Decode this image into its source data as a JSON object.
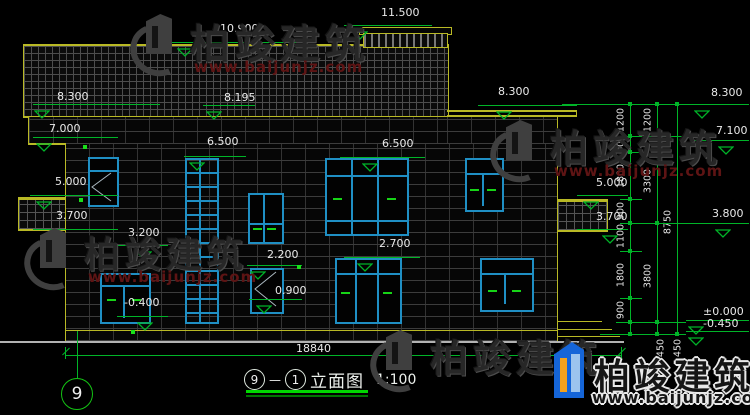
{
  "drawing": {
    "axis_bubble": "9",
    "title": {
      "left_bubble": "9",
      "dash": "—",
      "right_bubble": "1",
      "name": "立面图",
      "scale": "1:100"
    },
    "bottom_dimension": "18840"
  },
  "colors": {
    "outline_yellow": "#b9b925",
    "annotation_green": "#00b428",
    "window_cyan": "#1f8fc4",
    "text_white": "#e9e9e9",
    "watermark_red": "#5e1414",
    "logo_blue": "#1565d8",
    "logo_orange": "#f5a21b"
  },
  "elevations": [
    {
      "label": "10.900",
      "tx": 220,
      "ty": 23,
      "lx1": 164,
      "lx2": 305,
      "ly": 42,
      "trx": 177
    },
    {
      "label": "11.500",
      "tx": 381,
      "ty": 7,
      "lx1": 344,
      "lx2": 432,
      "ly": 25,
      "trx": 352
    },
    {
      "label": "8.300",
      "tx": 57,
      "ty": 91,
      "lx1": 33,
      "lx2": 160,
      "ly": 104,
      "trx": 34
    },
    {
      "label": "8.195",
      "tx": 224,
      "ty": 92,
      "lx1": 203,
      "lx2": 255,
      "ly": 105,
      "trx": 206
    },
    {
      "label": "8.300",
      "tx": 498,
      "ty": 86,
      "lx1": 478,
      "lx2": 577,
      "ly": 105,
      "trx": 496
    },
    {
      "label": "8.300",
      "tx": 711,
      "ty": 87,
      "lx1": 692,
      "lx2": 749,
      "ly": 104,
      "trx": 694
    },
    {
      "label": "7.000",
      "tx": 49,
      "ty": 123,
      "lx1": 33,
      "lx2": 118,
      "ly": 137,
      "trx": 36
    },
    {
      "label": "7.100",
      "tx": 716,
      "ty": 125,
      "lx1": 692,
      "lx2": 749,
      "ly": 140,
      "trx": 718
    },
    {
      "label": "6.500",
      "tx": 207,
      "ty": 136,
      "lx1": 184,
      "lx2": 246,
      "ly": 156,
      "trx": 189
    },
    {
      "label": "6.500",
      "tx": 382,
      "ty": 138,
      "lx1": 340,
      "lx2": 425,
      "ly": 157,
      "trx": 362
    },
    {
      "label": "5.000",
      "tx": 55,
      "ty": 176,
      "lx1": 30,
      "lx2": 118,
      "ly": 195,
      "trx": 36
    },
    {
      "label": "5.000",
      "tx": 596,
      "ty": 177,
      "lx1": 577,
      "lx2": 628,
      "ly": 195,
      "trx": 583
    },
    {
      "label": "3.700",
      "tx": 56,
      "ty": 210,
      "lx1": 33,
      "lx2": 118,
      "ly": 229,
      "trx": 40
    },
    {
      "label": "3.700",
      "tx": 596,
      "ty": 211,
      "lx1": 577,
      "lx2": 628,
      "ly": 229,
      "trx": 602
    },
    {
      "label": "3.800",
      "tx": 712,
      "ty": 208,
      "lx1": 692,
      "lx2": 749,
      "ly": 223,
      "trx": 715
    },
    {
      "label": "3.200",
      "tx": 128,
      "ty": 227,
      "lx1": 117,
      "lx2": 168,
      "ly": 245,
      "trx": 136
    },
    {
      "label": "2.700",
      "tx": 379,
      "ty": 238,
      "lx1": 344,
      "lx2": 420,
      "ly": 257,
      "trx": 357
    },
    {
      "label": "2.200",
      "tx": 267,
      "ty": 249,
      "lx1": 247,
      "lx2": 302,
      "ly": 265,
      "trx": 250
    },
    {
      "label": "0.900",
      "tx": 275,
      "ty": 285,
      "lx1": 249,
      "lx2": 302,
      "ly": 299,
      "trx": 256
    },
    {
      "label": "-0.400",
      "tx": 124,
      "ty": 297,
      "lx1": 117,
      "lx2": 168,
      "ly": 316,
      "trx": 137
    },
    {
      "label": "±0.000",
      "tx": 703,
      "ty": 306,
      "lx1": 686,
      "lx2": 749,
      "ly": 320,
      "trx": 688
    },
    {
      "label": "-0.450",
      "tx": 703,
      "ty": 318,
      "lx1": 686,
      "lx2": 749,
      "ly": 331,
      "trx": 688
    }
  ],
  "dim_chains": [
    {
      "x": 630,
      "y1": 104,
      "y2": 334,
      "ticks": [
        104,
        136,
        152,
        199,
        223,
        251,
        298,
        322,
        334
      ],
      "labels": [
        {
          "t": "1200",
          "y": 120
        },
        {
          "t": "600",
          "y": 144
        },
        {
          "t": "1800",
          "y": 176
        },
        {
          "t": "900",
          "y": 211
        },
        {
          "t": "1100",
          "y": 236
        },
        {
          "t": "1800",
          "y": 275
        },
        {
          "t": "900",
          "y": 310
        }
      ]
    },
    {
      "x": 657,
      "y1": 104,
      "y2": 334,
      "ticks": [
        104,
        136,
        223,
        322,
        334
      ],
      "labels": [
        {
          "t": "1200",
          "y": 120
        },
        {
          "t": "3300",
          "y": 181
        },
        {
          "t": "3800",
          "y": 276
        }
      ]
    },
    {
      "x": 677,
      "y1": 104,
      "y2": 334,
      "ticks": [
        104,
        334
      ],
      "labels": [
        {
          "t": "8750",
          "y": 222
        }
      ]
    }
  ],
  "chain_extra_labels": [
    {
      "t": "450",
      "x": 661,
      "y": 348
    },
    {
      "t": "450",
      "x": 678,
      "y": 348
    }
  ],
  "right_connectors": [
    {
      "y": 104,
      "x1": 562,
      "x2": 692
    },
    {
      "y": 136,
      "x1": 620,
      "x2": 692
    },
    {
      "y": 152,
      "x1": 620,
      "x2": 642
    },
    {
      "y": 199,
      "x1": 620,
      "x2": 642
    },
    {
      "y": 223,
      "x1": 620,
      "x2": 712
    },
    {
      "y": 251,
      "x1": 620,
      "x2": 642
    },
    {
      "y": 298,
      "x1": 620,
      "x2": 642
    },
    {
      "y": 322,
      "x1": 616,
      "x2": 686
    },
    {
      "y": 334,
      "x1": 600,
      "x2": 686
    }
  ],
  "green_dots": [
    {
      "x": 83,
      "y": 145
    },
    {
      "x": 79,
      "y": 198
    },
    {
      "x": 131,
      "y": 330
    },
    {
      "x": 297,
      "y": 265
    }
  ],
  "watermark": {
    "brand": "柏竣建筑",
    "url": "www.baijunjz.com",
    "instances": [
      {
        "style": "dark",
        "x": 128,
        "y": 10,
        "size": 40,
        "logo": "gray"
      },
      {
        "style": "dark",
        "x": 22,
        "y": 224,
        "size": 36,
        "logo": "gray"
      },
      {
        "style": "dark",
        "x": 488,
        "y": 116,
        "size": 38,
        "logo": "gray"
      },
      {
        "style": "dark",
        "x": 368,
        "y": 326,
        "size": 38,
        "logo": "gray",
        "nourl": true
      },
      {
        "style": "bright",
        "x": 552,
        "y": 340,
        "size": 36,
        "logo": "blue"
      }
    ]
  }
}
